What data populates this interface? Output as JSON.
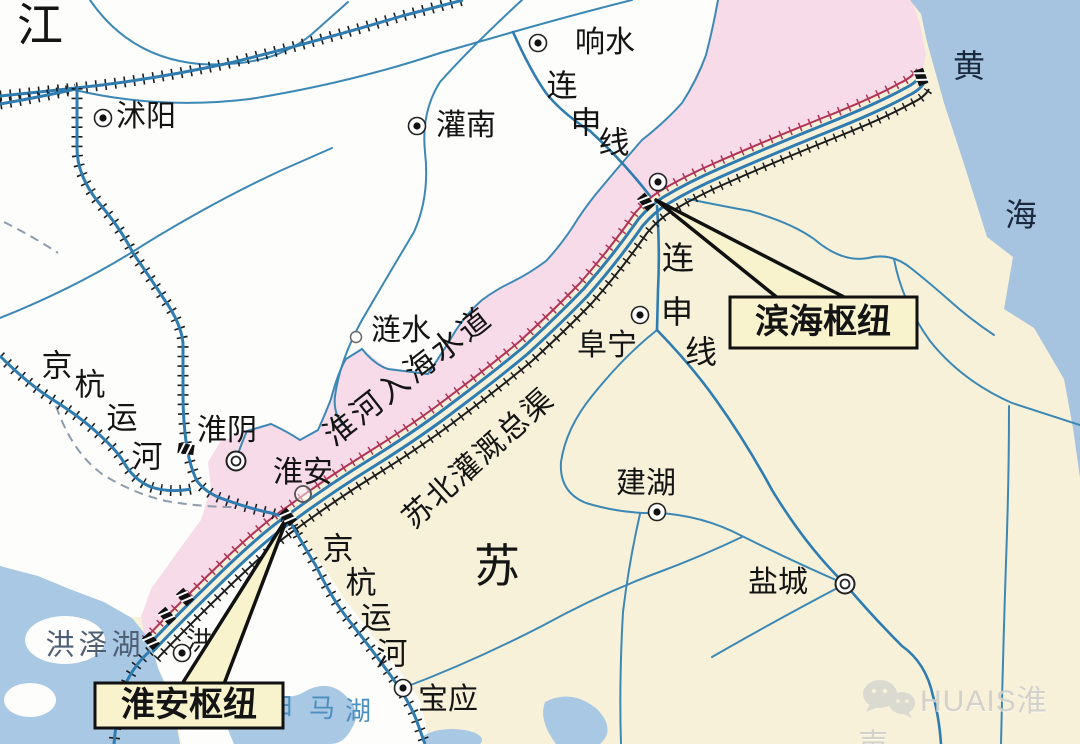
{
  "colors": {
    "land": "#f8f1da",
    "whiteregion": "#fdfdfc",
    "sea": "#a6c4df",
    "lake": "#a9c8e3",
    "pink": "#f7dbe8",
    "river": "#3c88b5",
    "canal": "#2e7cb0",
    "leveered": "#b13457",
    "leveeblack": "#1d1d1d",
    "boxfill": "#f8f2cd",
    "boxline": "#111111",
    "maptext": "#141414",
    "seatext": "#1b2940",
    "laketext": "#4e5e74",
    "bluetext": "#4a8fc0",
    "watermark": "#cfcfc9"
  },
  "regions": {
    "jiang": "江",
    "su": "苏"
  },
  "sea": {
    "chars": [
      "黄",
      "海"
    ]
  },
  "lakes": {
    "hongze": "洪泽湖",
    "baima_chars": [
      "白",
      "马",
      "湖"
    ]
  },
  "waterways": {
    "huaihe_estuary": "淮河入海水道",
    "irrigation_canal": "苏北灌溉总渠",
    "grand_canal_chars": [
      "京",
      "杭",
      "运",
      "河"
    ],
    "lianshen_chars": [
      "连",
      "申",
      "线"
    ]
  },
  "cities": {
    "shuyang": "沭阳",
    "guannan": "灌南",
    "xiangshui": "响水",
    "lianshui": "涟水",
    "huaiyin": "淮阴",
    "huaian": "淮安",
    "funing": "阜宁",
    "jianhu": "建湖",
    "yancheng": "盐城",
    "baoying": "宝应",
    "hong_partial": "洪"
  },
  "callouts": {
    "binhai_hub": "滨海枢纽",
    "huaian_hub": "淮安枢纽"
  },
  "watermark": {
    "brand": "HUAIS淮声"
  }
}
